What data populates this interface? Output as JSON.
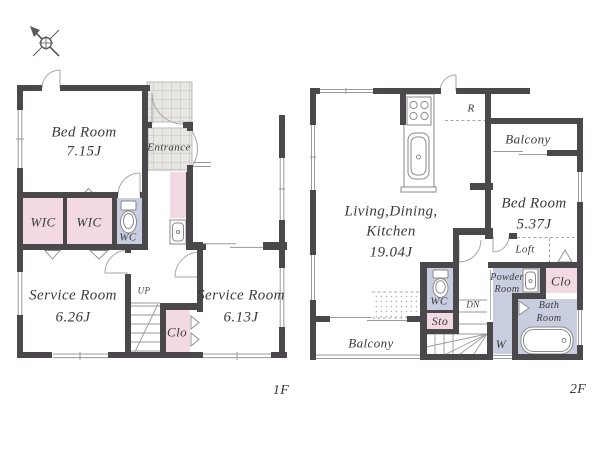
{
  "colors": {
    "wall": "#4b484b",
    "pink": "#f3d9e4",
    "blue": "#c8cde0",
    "tile": "#e8e6e3",
    "line": "#9a9a9a",
    "text": "#3a3a3a",
    "background": "#ffffff"
  },
  "icons": [
    "north-arrow",
    "toilet",
    "bathtub",
    "kitchen-sink",
    "stove",
    "washbasin",
    "stairs",
    "door-arc",
    "tile-floor"
  ],
  "floor1": {
    "label": "1F",
    "bedroom": {
      "name": "Bed Room",
      "size": "7.15J"
    },
    "entrance": {
      "name": "Entrance"
    },
    "wic_left": {
      "name": "WIC"
    },
    "wic_right": {
      "name": "WIC"
    },
    "wc": {
      "name": "WC"
    },
    "service_room_left": {
      "name": "Service Room",
      "size": "6.26J"
    },
    "service_room_right": {
      "name": "Service Room",
      "size": "6.13J"
    },
    "stairs": {
      "name": "UP"
    },
    "closet": {
      "name": "Clo"
    }
  },
  "floor2": {
    "label": "2F",
    "ldk": {
      "line1": "Living,Dining,",
      "line2": "Kitchen",
      "size": "19.04J"
    },
    "refrigerator": {
      "name": "R"
    },
    "balcony_top": {
      "name": "Balcony"
    },
    "bedroom": {
      "name": "Bed Room",
      "size": "5.37J"
    },
    "loft": {
      "name": "Loft"
    },
    "powder_room": {
      "line1": "Powder",
      "line2": "Room"
    },
    "closet": {
      "name": "Clo"
    },
    "wc": {
      "name": "WC"
    },
    "stairs": {
      "name": "DN"
    },
    "storage": {
      "name": "Sto"
    },
    "washer": {
      "name": "W"
    },
    "bath_room": {
      "line1": "Bath",
      "line2": "Room"
    },
    "balcony_bottom": {
      "name": "Balcony"
    }
  }
}
